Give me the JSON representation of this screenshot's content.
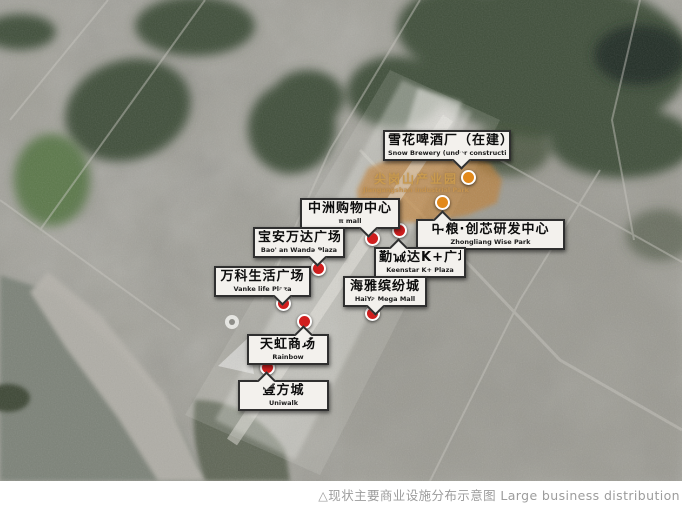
{
  "figure": {
    "caption": "△现状主要商业设施分布示意图 Large business distribution"
  },
  "park_zone": {
    "cn": "尖岗山产业园",
    "en": "Jiangangshan Industrial Park"
  },
  "labels": [
    {
      "cn": "雪花啤酒厂（在建）",
      "en": "Snow Brewery (under construction)",
      "marker": "orange"
    },
    {
      "cn": "中洲购物中心",
      "en": "π mall",
      "marker": "red"
    },
    {
      "cn": "中粮·创芯研发中心",
      "en": "Zhongliang Wise Park",
      "marker": "orange"
    },
    {
      "cn": "宝安万达广场",
      "en": "Bao' an Wanda Plaza",
      "marker": "red"
    },
    {
      "cn": "勤诚达K+广场",
      "en": "Keenstar K+ Plaza",
      "marker": "red"
    },
    {
      "cn": "万科生活广场",
      "en": "Vanke life Plaza",
      "marker": "red"
    },
    {
      "cn": "海雅缤纷城",
      "en": "HaiYa Mega Mall",
      "marker": "red"
    },
    {
      "cn": "天虹商场",
      "en": "Rainbow",
      "marker": "red"
    },
    {
      "cn": "壹方城",
      "en": "Uniwalk",
      "marker": "red"
    }
  ],
  "colors": {
    "marker_red": "#d01e1e",
    "marker_orange": "#e2891b",
    "zone_orange": "rgba(193,125,47,0.62)",
    "park_text": "#c99a4e",
    "caption_gray": "#9c9c9c",
    "label_bg": "#f3f1ed",
    "label_border": "#2f2f2f"
  }
}
